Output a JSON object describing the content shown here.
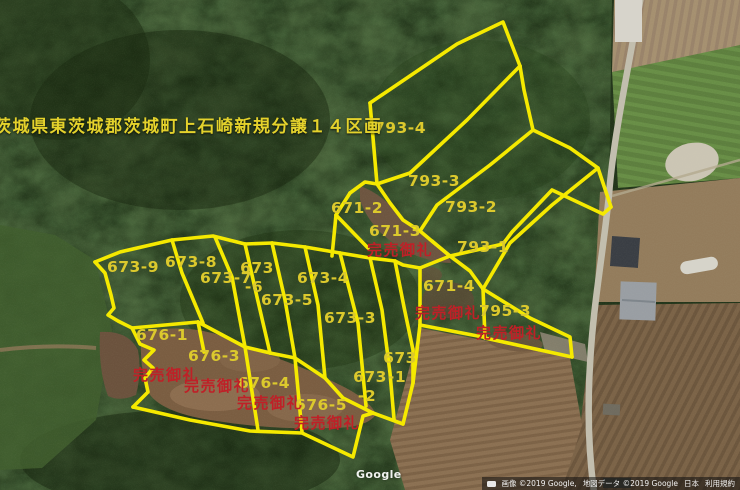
{
  "title": "茨城県東茨城郡茨城町上石崎新規分譲１４区画",
  "watermark": "Google",
  "attribution": {
    "imagery": "画像 ©2019 Google,",
    "map_data": "地図データ ©2019 Google",
    "region": "日本",
    "terms": "利用規約"
  },
  "map": {
    "colors": {
      "boundary": "#f5e900",
      "parcel_label": "#dcc92d",
      "sold_label": "#bf2027",
      "title": "#e4d22c"
    },
    "parcels": [
      {
        "id": "793-4",
        "lines": [
          "793-4"
        ],
        "x": 400,
        "y": 133
      },
      {
        "id": "793-3",
        "lines": [
          "793-3"
        ],
        "x": 434,
        "y": 186
      },
      {
        "id": "793-2",
        "lines": [
          "793-2"
        ],
        "x": 471,
        "y": 212
      },
      {
        "id": "793-1",
        "lines": [
          "793-1"
        ],
        "x": 483,
        "y": 252
      },
      {
        "id": "671-2",
        "lines": [
          "671-2"
        ],
        "x": 357,
        "y": 213
      },
      {
        "id": "671-3",
        "lines": [
          "671-3"
        ],
        "x": 395,
        "y": 236
      },
      {
        "id": "671-4",
        "lines": [
          "671-4"
        ],
        "x": 449,
        "y": 291
      },
      {
        "id": "795-3",
        "lines": [
          "795-3"
        ],
        "x": 505,
        "y": 316
      },
      {
        "id": "673-9",
        "lines": [
          "673-9"
        ],
        "x": 133,
        "y": 272
      },
      {
        "id": "673-8",
        "lines": [
          "673-8"
        ],
        "x": 191,
        "y": 267
      },
      {
        "id": "673-7",
        "lines": [
          "673-7"
        ],
        "x": 226,
        "y": 283
      },
      {
        "id": "673-6",
        "lines": [
          "673",
          "-6"
        ],
        "x": 257,
        "y": 273
      },
      {
        "id": "673-5",
        "lines": [
          "673-5"
        ],
        "x": 287,
        "y": 305
      },
      {
        "id": "673-4",
        "lines": [
          "673-4"
        ],
        "x": 323,
        "y": 283
      },
      {
        "id": "673-3",
        "lines": [
          "673-3"
        ],
        "x": 350,
        "y": 323
      },
      {
        "id": "673-2",
        "lines": [
          "673",
          "-2"
        ],
        "x": 370,
        "y": 382
      },
      {
        "id": "673-1",
        "lines": [
          "673",
          "-1"
        ],
        "x": 400,
        "y": 363
      },
      {
        "id": "676-1",
        "lines": [
          "676-1"
        ],
        "x": 162,
        "y": 340
      },
      {
        "id": "676-3",
        "lines": [
          "676-3"
        ],
        "x": 214,
        "y": 361
      },
      {
        "id": "676-4",
        "lines": [
          "676-4"
        ],
        "x": 264,
        "y": 388
      },
      {
        "id": "676-5",
        "lines": [
          "676-5"
        ],
        "x": 321,
        "y": 410
      }
    ],
    "sold_labels": [
      {
        "text": "完売御礼",
        "x": 400,
        "y": 255
      },
      {
        "text": "完売御礼",
        "x": 448,
        "y": 318
      },
      {
        "text": "完売御礼",
        "x": 509,
        "y": 338
      },
      {
        "text": "完売御礼",
        "x": 166,
        "y": 380
      },
      {
        "text": "完売御礼",
        "x": 217,
        "y": 391
      },
      {
        "text": "完売御礼",
        "x": 270,
        "y": 408
      },
      {
        "text": "完売御礼",
        "x": 327,
        "y": 428
      }
    ],
    "boundaries": [
      "370,103 457,44 503,22 520,66",
      "520,66 467,120 410,173 377,184",
      "370,103 377,184",
      "520,66 524,90 533,130",
      "533,130 490,165 437,205 420,231",
      "533,130 570,148 598,168 611,207",
      "611,207 603,214 552,190 512,232 503,244 450,256 432,241",
      "598,168 552,205 510,243 483,289",
      "350,193 365,182 377,184",
      "350,193 336,215",
      "336,215 368,248",
      "336,215 332,256",
      "377,184 390,203 403,220 420,231 433,242 450,256",
      "95,262 120,252 172,240 213,236 245,244 272,243 305,247 340,253 370,258 395,261 403,265 420,268",
      "95,262 105,273 111,295 114,308 108,315 118,321 132,328",
      "132,328 198,322",
      "172,240 182,273 203,323",
      "215,237 232,277 245,347",
      "245,244 257,297 270,353",
      "272,243 285,300 295,358",
      "305,247 318,305 325,378",
      "340,253 358,323 366,406",
      "370,258 382,310 390,373 394,419",
      "395,261 404,307 413,350 413,383",
      "198,322 245,347 270,353 295,358 310,368 325,378 343,398 373,413 403,424",
      "198,322 204,352",
      "245,347 258,430",
      "295,358 302,432",
      "132,328 140,344 154,350 144,360 153,368 145,378 148,392 133,407",
      "133,407 190,420 250,431 302,433 353,457 363,416 373,413",
      "420,268 420,325",
      "420,268 450,256",
      "450,256 470,271 483,289",
      "420,325 483,337",
      "483,289 485,338",
      "483,289 530,318 570,337 572,357",
      "485,338 572,357",
      "403,424 413,383 420,325"
    ]
  }
}
